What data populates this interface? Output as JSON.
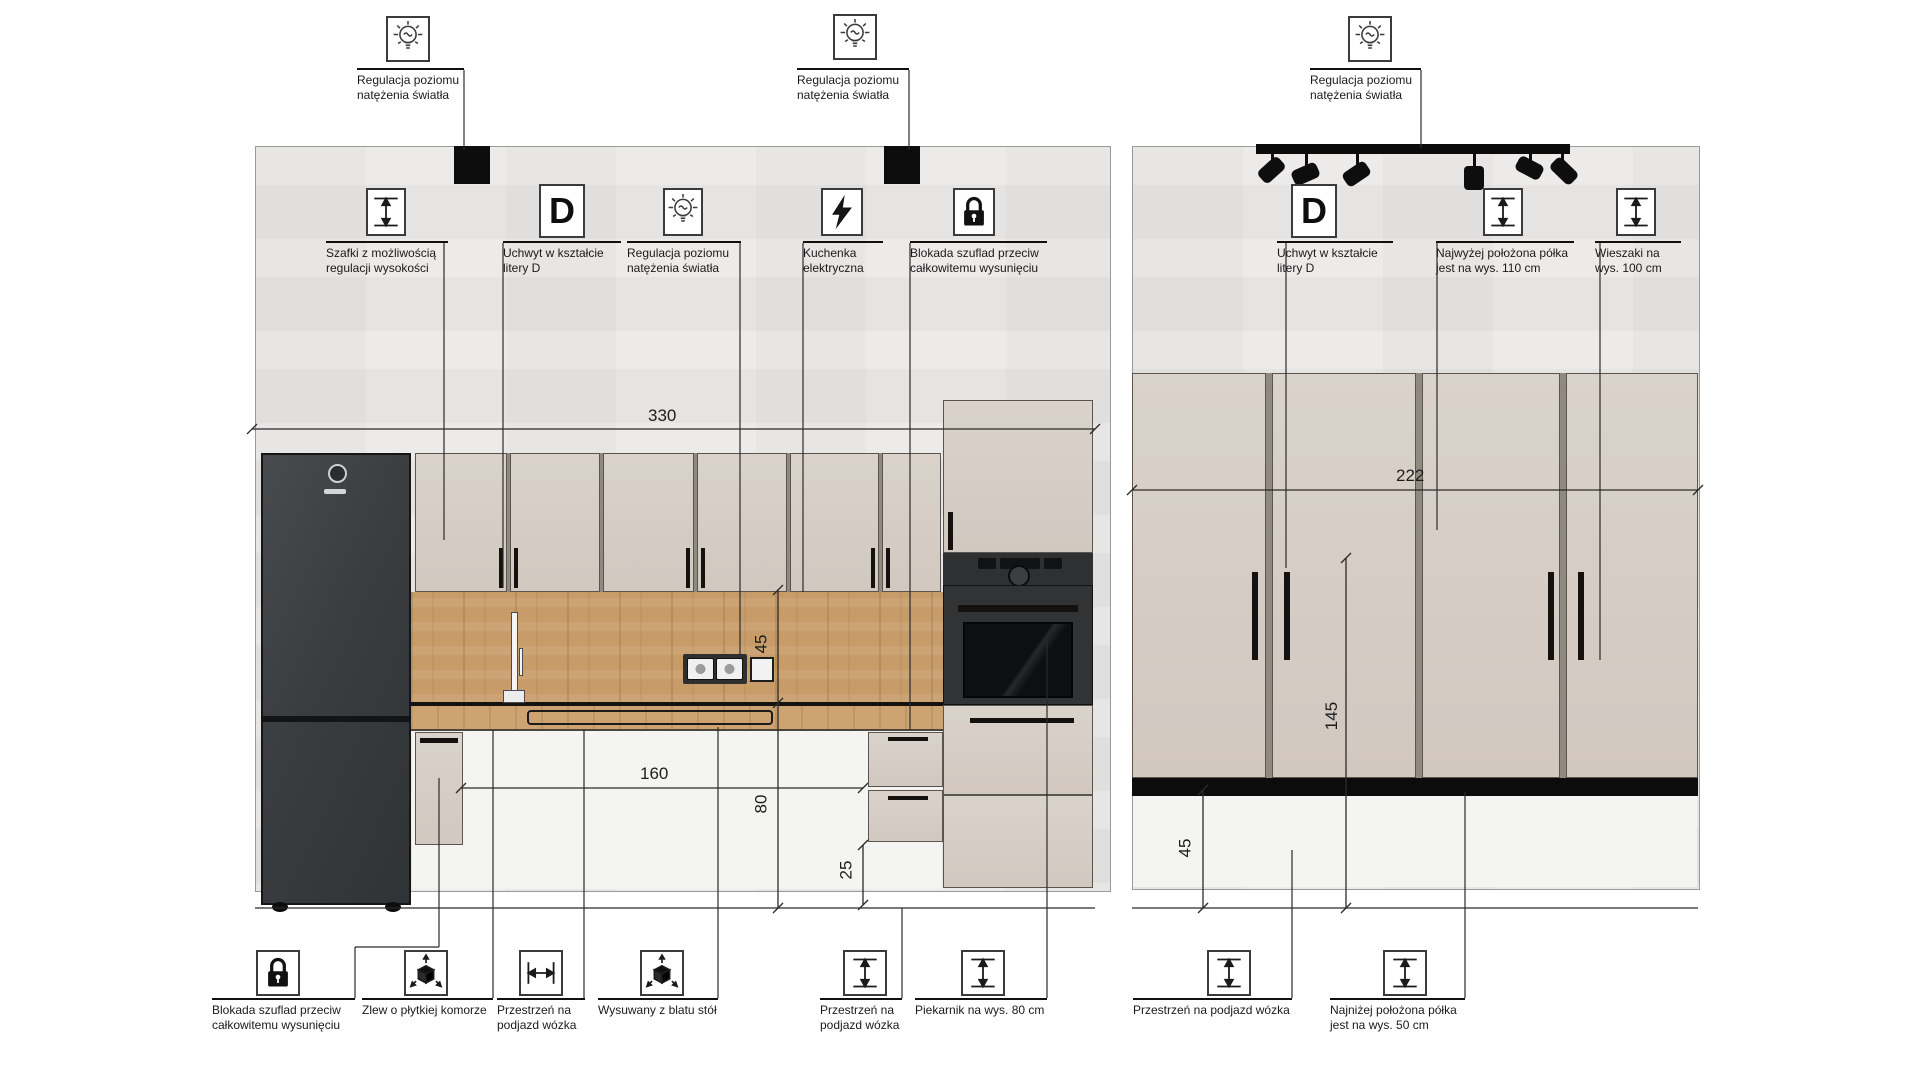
{
  "annotations": {
    "top": [
      {
        "icon": "bulb-icon",
        "label": "Regulacja poziomu natężenia światła"
      },
      {
        "icon": "bulb-icon",
        "label": "Regulacja poziomu natężenia światła"
      },
      {
        "icon": "bulb-icon",
        "label": "Regulacja poziomu natężenia światła"
      }
    ],
    "left_row": [
      {
        "icon": "height-adjust-icon",
        "label": "Szafki z możliwością regulacji wysokości"
      },
      {
        "icon": "d-handle-icon",
        "glyph": "D",
        "label": "Uchwyt w kształcie litery D"
      },
      {
        "icon": "bulb-icon",
        "label": "Regulacja poziomu natężenia światła"
      },
      {
        "icon": "lightning-icon",
        "label": "Kuchenka elektryczna"
      },
      {
        "icon": "lock-icon",
        "label": "Blokada szuflad przeciw całkowitemu wysunięciu"
      }
    ],
    "right_row": [
      {
        "icon": "d-handle-icon",
        "glyph": "D",
        "label": "Uchwyt w kształcie litery D"
      },
      {
        "icon": "height-adjust-icon",
        "label": "Najwyżej położona półka jest na wys. 110 cm"
      },
      {
        "icon": "height-adjust-icon",
        "label": "Wieszaki na wys. 100 cm"
      }
    ],
    "bottom": [
      {
        "icon": "lock-icon",
        "label": "Blokada szuflad przeciw całkowitemu wysunięciu"
      },
      {
        "icon": "cube-arrows-icon",
        "label": "Zlew o płytkiej komorze"
      },
      {
        "icon": "width-adjust-icon",
        "label": "Przestrzeń na podjazd wózka"
      },
      {
        "icon": "cube-arrows-icon",
        "label": "Wysuwany z blatu stół"
      },
      {
        "icon": "height-adjust-icon",
        "label": "Przestrzeń na podjazd wózka"
      },
      {
        "icon": "height-adjust-icon",
        "label": "Piekarnik na wys. 80 cm"
      },
      {
        "icon": "height-adjust-icon",
        "label": "Przestrzeń na podjazd wózka"
      },
      {
        "icon": "height-adjust-icon",
        "label": "Najniżej położona półka jest na wys. 50 cm"
      }
    ]
  },
  "dimensions": {
    "kitchen_run_width": "330",
    "clearance_width": "160",
    "backsplash_height": "45",
    "worktop_height": "80",
    "plinth_height": "25",
    "wardrobe_width": "222",
    "wardrobe_door_height": "145",
    "wardrobe_clearance_height": "45"
  },
  "colors": {
    "wall": "#e9e8e6",
    "cabinet": "#d7cfc7",
    "wood": "#c79c69",
    "appliance_dark": "#35383a",
    "line": "#2b2b2b"
  }
}
